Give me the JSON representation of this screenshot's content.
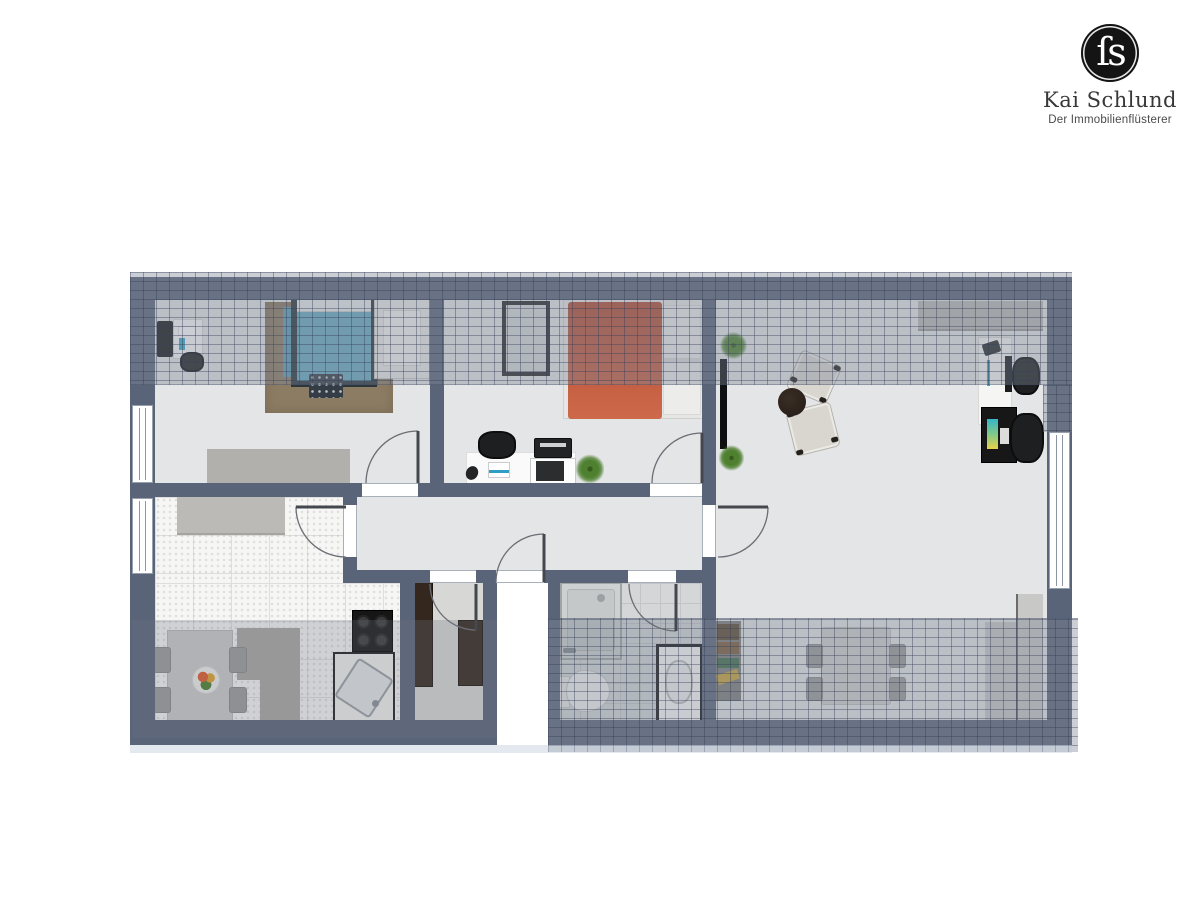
{
  "logo": {
    "monogram": "ſs",
    "brand": "Kai Schlund",
    "tagline": "Der Immobilienflüsterer"
  },
  "palette": {
    "wall": "#5a6479",
    "floor": "#e4e5e7",
    "kitchen_tile": "#f6f6f5",
    "bath_tile": "#d5d6d8",
    "roof_hatch": "#7e8696",
    "bed_teal": "#6aa8c0",
    "bed_terracotta": "#c0573e",
    "rug_brown": "#8d7c64",
    "wardrobe_brown": "#34281e",
    "counter_gray": "#bcbab6",
    "plant_green": "#4e8030",
    "logo_black": "#141414"
  },
  "floorplan": {
    "style": "rendered top-down attic floor plan with sloped-ceiling hatch bands",
    "rooms": [
      {
        "name": "bedroom-1",
        "position": "top-left",
        "furniture": [
          "desk with monitor and chair",
          "double bed with teal bedding",
          "brown area rug",
          "patterned bench",
          "white lounge chair",
          "sideboard"
        ]
      },
      {
        "name": "bedroom-2",
        "position": "top-middle",
        "furniture": [
          "leaning mirror",
          "double bed with terracotta bedding",
          "desk with office chair",
          "printer",
          "copier",
          "potted plant"
        ]
      },
      {
        "name": "living-room",
        "position": "right",
        "furniture": [
          "wall shelf",
          "white desk with chair",
          "black desk with chair",
          "wall-mounted tv",
          "two armchairs",
          "round coffee table",
          "two potted plants",
          "dining table with four chairs",
          "bookshelf",
          "knee-wall platform"
        ]
      },
      {
        "name": "kitchen",
        "position": "bottom-left",
        "furniture": [
          "counter",
          "kitchen island",
          "dining table with four chairs",
          "fruit bowl",
          "four-burner stove",
          "sink unit"
        ]
      },
      {
        "name": "storage-room",
        "position": "bottom-middle-left",
        "furniture": [
          "two dark wardrobes"
        ]
      },
      {
        "name": "bathroom",
        "position": "bottom-middle",
        "furniture": [
          "shower",
          "toilet",
          "washbasin vanity"
        ]
      },
      {
        "name": "hallway",
        "position": "center",
        "furniture": []
      }
    ],
    "windows": 3,
    "doors": 7
  }
}
